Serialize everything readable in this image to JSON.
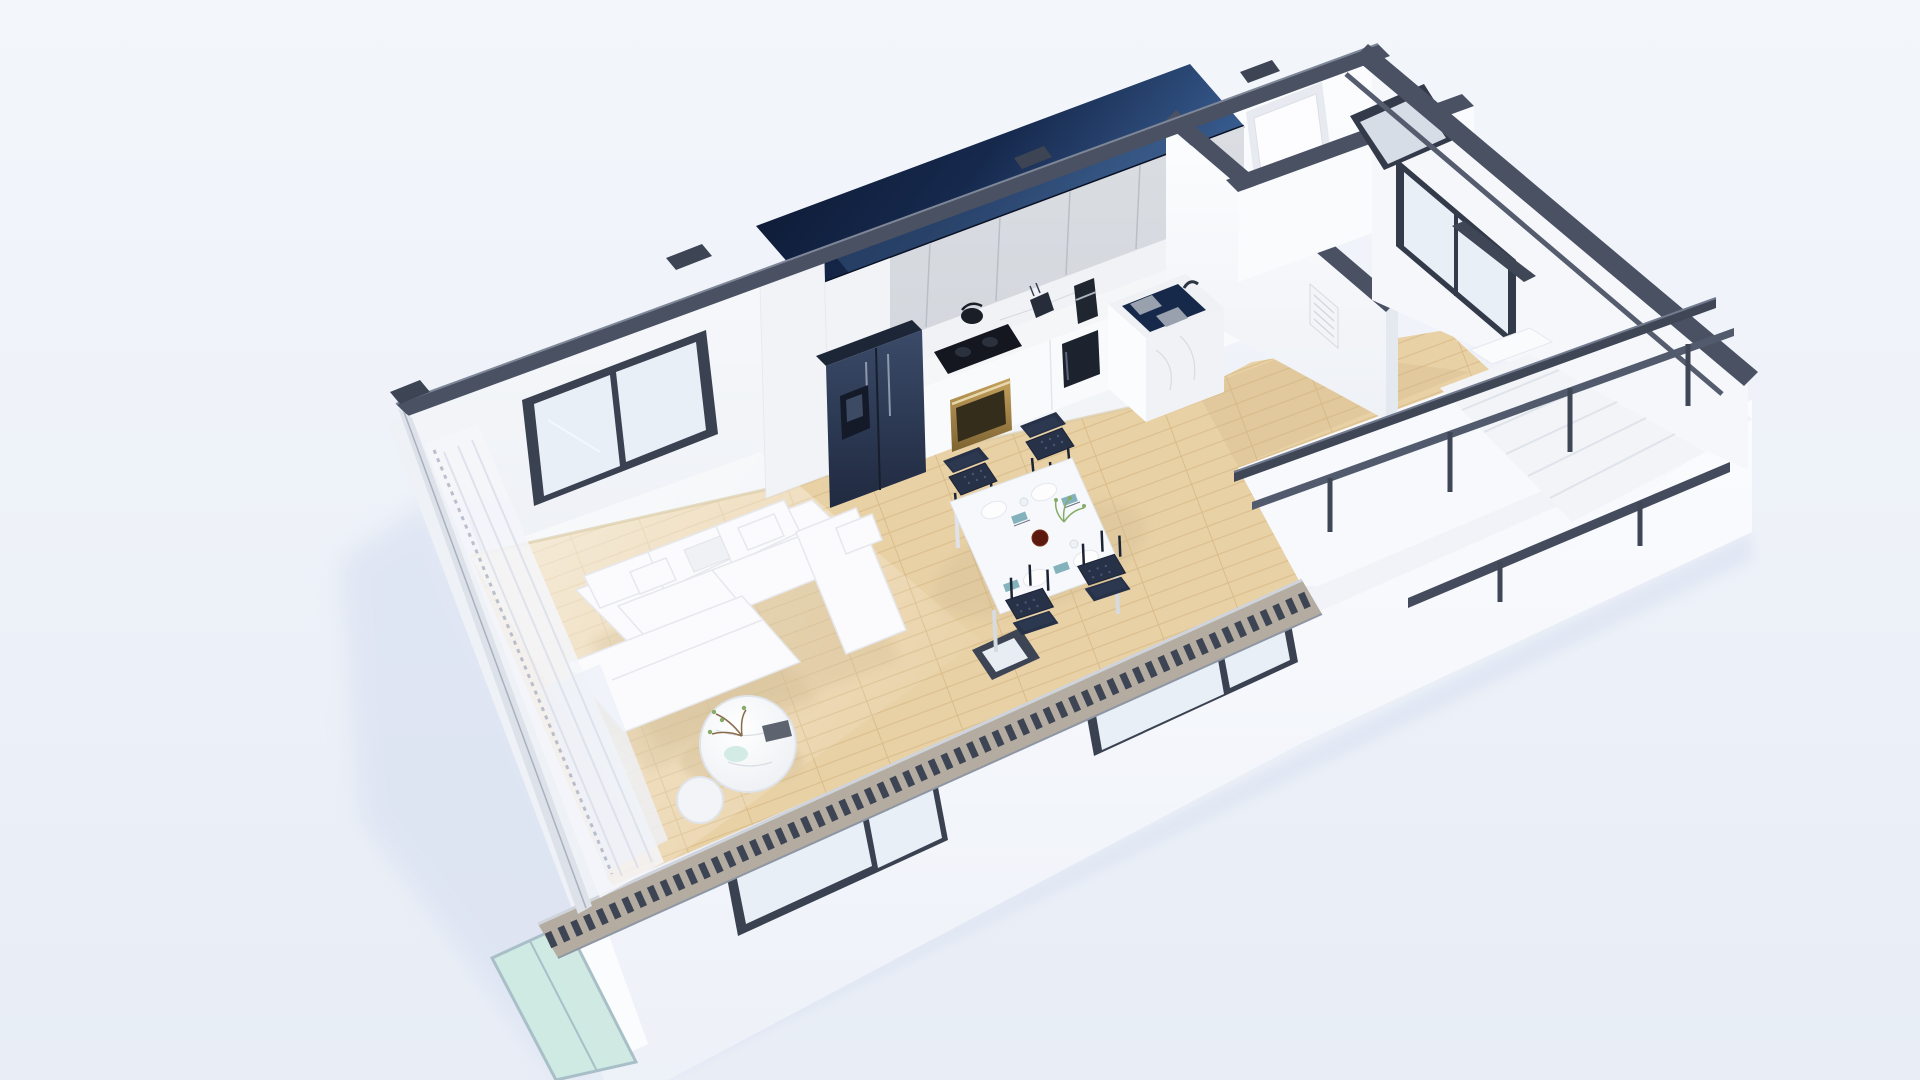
{
  "meta": {
    "title": "3D isometric cutaway floor plan render of a studio apartment",
    "style": "photorealistic architectural render, top-down isometric, no visible text"
  },
  "colors": {
    "bgTop": "#f3f6fb",
    "bgBottom": "#e8edf6",
    "facade": "#fbfcfe",
    "wall": "#fcfdfe",
    "wallShade": "#eef1f6",
    "cap": "#4a5163",
    "capDark": "#3d4454",
    "capLight": "#7e8798",
    "navyDark": "#0a142b",
    "navyMid": "#16294d",
    "navyLight": "#3a5f93",
    "cabinetGray": "#d3d7dd",
    "cabinetSeam": "#b9bec7",
    "cabinetWhite": "#f1f3f7",
    "marble": "#f0f2f5",
    "marbleVein": "#d8dce3",
    "counterWhite": "#f9fafc",
    "woodBase": "#e9d1a6",
    "woodLine": "#dcc08e",
    "woodDark": "#d9bc8a",
    "woodShadow": "#cdb283",
    "floorWhite": "#f7f9fc",
    "fridgeLight": "#3a4a68",
    "fridgeDark": "#202a40",
    "applianceBlack": "#14171f",
    "gold": "#c5a15c",
    "goldDark": "#7d6332",
    "sinkNavy": "#16294a",
    "sofaWhite": "#fbfbfd",
    "sofaLine": "#e6e8ee",
    "chairNavy": "#273148",
    "chairDark": "#1b2334",
    "tableWhite": "#f6f8fb",
    "napkinTeal": "#84b2bc",
    "bowlRed": "#5c190f",
    "plantGreen": "#86ab66",
    "twigBrown": "#8a6b4a",
    "glassPane": "#e9eff7",
    "glassTeal": "#cde9e1",
    "frameDark": "#3a4150",
    "rail": "#3f4655",
    "railLight": "#727b8e",
    "shadowBlue": "#d7dff0",
    "shadowWarm": "#cdb88e"
  },
  "scene": {
    "background": "soft blue-white gradient",
    "building": "single-storey rectangular apartment cut open at wall tops; dark slate cut caps; glossy navy kitchen bulkhead; white facade below",
    "rooms": [
      {
        "name": "living-room",
        "floor": "light-oak"
      },
      {
        "name": "dining-area",
        "floor": "light-oak"
      },
      {
        "name": "kitchen",
        "floor": "light-oak"
      },
      {
        "name": "hallway",
        "floor": "light-oak"
      },
      {
        "name": "stair-hall",
        "floor": "white"
      },
      {
        "name": "entry",
        "floor": "light-oak"
      }
    ],
    "furniture": [
      "sectional-sofa",
      "ottoman-daybed",
      "coffee-table-large",
      "coffee-table-small",
      "dining-table",
      "dining-chair-x4",
      "refrigerator",
      "upper-cabinets",
      "lower-cabinets",
      "cooktop",
      "oven",
      "sink-island",
      "microwave",
      "coffee-maker",
      "knife-block",
      "kettle",
      "staircase",
      "stair-railing",
      "entry-door",
      "sheer-curtains"
    ],
    "windows": [
      "back-wall-window",
      "right-wall-window",
      "open-casement-sash",
      "facade-window-1",
      "facade-window-2",
      "balcony-glass-door"
    ]
  }
}
